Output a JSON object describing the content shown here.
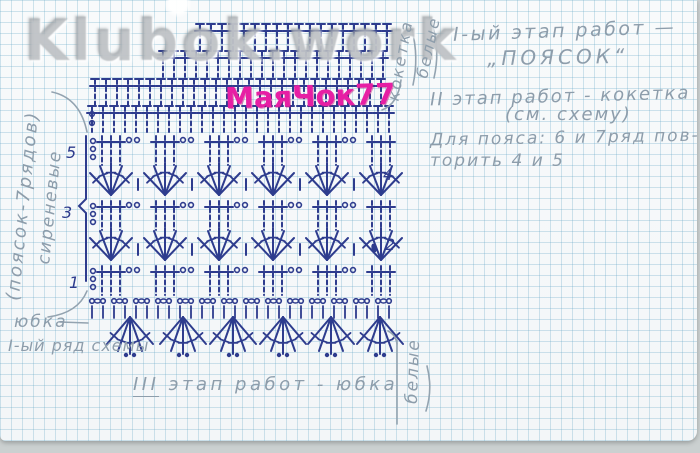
{
  "watermark": "Klubok.work",
  "brand": "МаяЧок77",
  "labels": {
    "left_rotated_1": "(поясок-7рядов)",
    "left_rotated_2": "сиреневые",
    "top_right_rotated_1": "кокетка",
    "top_right_rotated_2": "белые",
    "bottom_right_rotated": "белые",
    "skirt_label": "юбка",
    "skirt_sublabel": "I-ый ряд схемы",
    "stage3_prefix": "III",
    "stage3_rest": " этап работ - юбка"
  },
  "notes": {
    "line1": "I-ый этап работ —",
    "line2": "„ПОЯСОК“",
    "line3": "II этап работ - кокетка",
    "line4": "(см. схему)",
    "line5": "Для пояса: 6 и 7ряд пов-",
    "line6": "торить 4 и 5"
  },
  "colors": {
    "ink": "#2e3c8e",
    "pencil": "#93a3b0",
    "magenta": "#e71fa4",
    "grid": "#bad5e2",
    "paper": "#f8fafb",
    "backdrop": "#cbd0d0"
  },
  "diagram": {
    "ink": "#2e3c8e",
    "pencil": "#93a3b0",
    "spacing": 11,
    "yoke_rows": [
      {
        "x1": 200,
        "x2": 390,
        "y": 24
      },
      {
        "x1": 163,
        "x2": 390,
        "y": 51
      },
      {
        "x1": 95,
        "x2": 390,
        "y": 79
      },
      {
        "x1": 92,
        "x2": 390,
        "y": 106
      }
    ],
    "yoke_chains": [
      {
        "x": 92,
        "y": 114
      },
      {
        "x": 92,
        "y": 123
      }
    ],
    "belt": {
      "x1": 92,
      "x2": 390,
      "period": 54,
      "dc_rows_y": [
        135,
        200,
        265
      ],
      "fan_rows_y": [
        162,
        227
      ]
    },
    "foundation": {
      "x1": 92,
      "x2": 390,
      "y": 301
    },
    "skirt": {
      "y": 317,
      "centers": [
        130,
        183,
        233,
        283,
        331,
        380
      ]
    },
    "left_brace": "M 86,136 L 86,199 L 79,206 L 86,213 L 86,281",
    "right_mark": {
      "x": 374,
      "y": 248
    },
    "row_numbers": [
      {
        "t": "5",
        "x": 66,
        "y": 158
      },
      {
        "t": "3",
        "x": 62,
        "y": 218
      },
      {
        "t": "1",
        "x": 69,
        "y": 288
      },
      {
        "t": "4",
        "x": 383,
        "y": 180
      },
      {
        "t": "2",
        "x": 385,
        "y": 250
      }
    ],
    "pencil_paths": [
      "M 52,92 Q 80,98 87,132",
      "M 48,317 Q 78,313 87,291",
      "M 60,322 L 88,323",
      "M 382,110 Q 398,104 401,80",
      "M 413,85 Q 419,57 412,30",
      "M 434,78 Q 440,52 433,27",
      "M 397,340 L 397,424",
      "M 397,344 Q 396,335 388,331",
      "M 427,366 Q 433,389 426,411"
    ]
  }
}
